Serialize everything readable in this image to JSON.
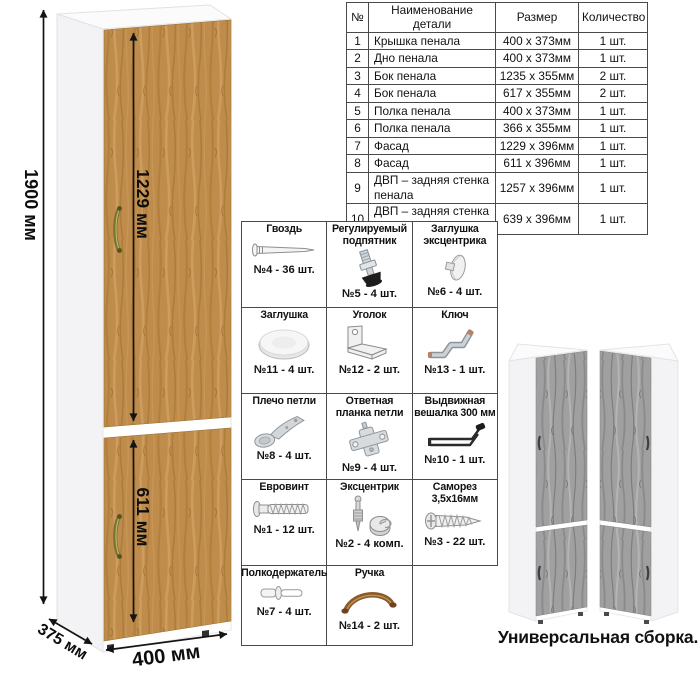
{
  "main_cabinet": {
    "dims": {
      "height": "1900 мм",
      "upper_door": "1229 мм",
      "lower_door": "611 мм",
      "depth": "375 мм",
      "width": "400 мм"
    }
  },
  "parts_table": {
    "headers": [
      "№",
      "Наименование детали",
      "Размер",
      "Количество"
    ],
    "rows": [
      {
        "num": "1",
        "name": "Крышка пенала",
        "size": "400 x 373мм",
        "qty": "1 шт."
      },
      {
        "num": "2",
        "name": "Дно пенала",
        "size": "400 x 373мм",
        "qty": "1 шт."
      },
      {
        "num": "3",
        "name": "Бок пенала",
        "size": "1235 x 355мм",
        "qty": "2 шт."
      },
      {
        "num": "4",
        "name": "Бок пенала",
        "size": "617 x 355мм",
        "qty": "2 шт."
      },
      {
        "num": "5",
        "name": "Полка пенала",
        "size": "400 x 373мм",
        "qty": "1 шт."
      },
      {
        "num": "6",
        "name": "Полка пенала",
        "size": "366 x 355мм",
        "qty": "1 шт."
      },
      {
        "num": "7",
        "name": "Фасад",
        "size": "1229 x 396мм",
        "qty": "1 шт."
      },
      {
        "num": "8",
        "name": "Фасад",
        "size": "611 x 396мм",
        "qty": "1 шт."
      },
      {
        "num": "9",
        "name": "ДВП – задняя стенка пенала",
        "size": "1257 x 396мм",
        "qty": "1 шт."
      },
      {
        "num": "10",
        "name": "ДВП – задняя стенка пенала",
        "size": "639 x 396мм",
        "qty": "1 шт."
      }
    ]
  },
  "hardware": {
    "items": [
      {
        "name": "Гвоздь",
        "qty": "№4 - 36 шт.",
        "icon": "nail-icon"
      },
      {
        "name": "Регулируемый подпятник",
        "qty": "№5 - 4 шт.",
        "icon": "adjustable-foot-icon"
      },
      {
        "name": "Заглушка эксцентрика",
        "qty": "№6 - 4 шт.",
        "icon": "cam-cap-icon"
      },
      {
        "name": "Заглушка",
        "qty": "№11 - 4 шт.",
        "icon": "cover-cap-icon"
      },
      {
        "name": "Уголок",
        "qty": "№12 - 2 шт.",
        "icon": "corner-bracket-icon"
      },
      {
        "name": "Ключ",
        "qty": "№13 - 1 шт.",
        "icon": "hex-key-icon"
      },
      {
        "name": "Плечо петли",
        "qty": "№8 - 4 шт.",
        "icon": "hinge-arm-icon"
      },
      {
        "name": "Ответная планка петли",
        "qty": "№9 - 4 шт.",
        "icon": "hinge-plate-icon"
      },
      {
        "name": "Выдвижная вешалка 300 мм",
        "qty": "№10 - 1 шт.",
        "icon": "pullout-hanger-icon"
      },
      {
        "name": "Евровинт",
        "qty": "№1 - 12 шт.",
        "icon": "euro-screw-icon"
      },
      {
        "name": "Эксцентрик",
        "qty": "№2 - 4 комп.",
        "icon": "cam-lock-icon"
      },
      {
        "name": "Саморез 3,5х16мм",
        "qty": "№3 - 22 шт.",
        "icon": "self-tapping-screw-icon"
      },
      {
        "name": "Полкодержатель",
        "qty": "№7 - 4 шт.",
        "icon": "shelf-pin-icon"
      },
      {
        "name": "Ручка",
        "qty": "№14 - 2 шт.",
        "icon": "handle-icon"
      }
    ]
  },
  "variants": {
    "caption": "Универсальная сборка."
  },
  "colors": {
    "oak_base": "#c08c4c",
    "oak_dark": "#a5762f",
    "oak_light": "#d3a96b",
    "gray_wood_base": "#a0a0a0",
    "gray_wood_dark": "#7e7e7e",
    "handle_brass": "#7a7233",
    "variant_handle": "#3f3f3f",
    "table_border": "#4a4a4a",
    "dimension_line": "#141414",
    "handle_brown": "#8a5a28"
  }
}
